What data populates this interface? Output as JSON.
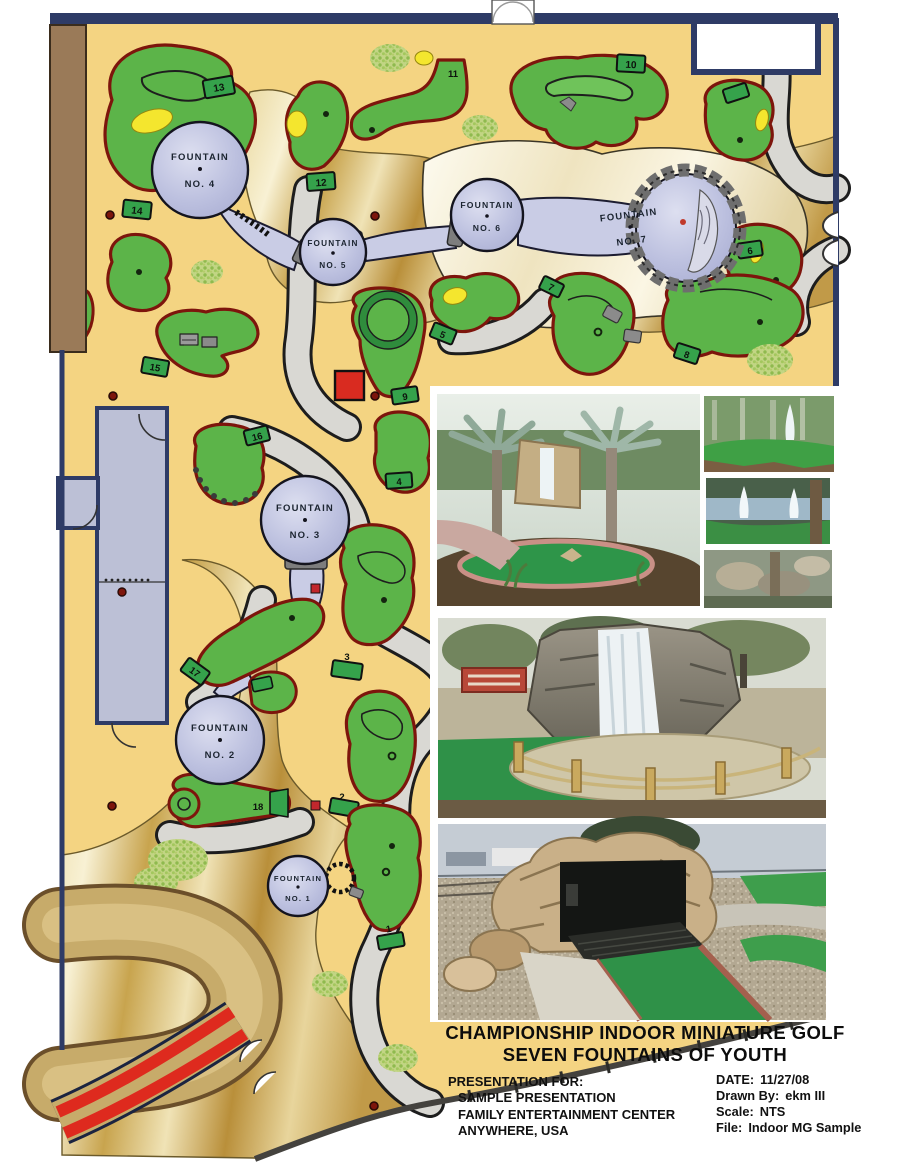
{
  "plan": {
    "fountains": [
      {
        "name": "FOUNTAIN",
        "no": "NO. 1"
      },
      {
        "name": "FOUNTAIN",
        "no": "NO. 2"
      },
      {
        "name": "FOUNTAIN",
        "no": "NO. 3"
      },
      {
        "name": "FOUNTAIN",
        "no": "NO. 4"
      },
      {
        "name": "FOUNTAIN",
        "no": "NO. 5"
      },
      {
        "name": "FOUNTAIN",
        "no": "NO. 6"
      },
      {
        "name": "FOUNTAIN",
        "no": "NO. 7"
      }
    ],
    "hole_numbers": [
      "1",
      "2",
      "3",
      "4",
      "5",
      "6",
      "7",
      "8",
      "9",
      "10",
      "11",
      "12",
      "13",
      "14",
      "15",
      "16",
      "17",
      "18"
    ]
  },
  "title_block": {
    "line1": "CHAMPIONSHIP INDOOR MINIATURE GOLF",
    "line2": "SEVEN FOUNTAINS OF YOUTH"
  },
  "presentation": {
    "heading": "PRESENTATION FOR:",
    "line1": "SAMPLE PRESENTATION",
    "line2": "FAMILY ENTERTAINMENT CENTER",
    "line3": "ANYWHERE, USA"
  },
  "meta": {
    "date_label": "DATE:",
    "date": "11/27/08",
    "drawn_label": "Drawn By:",
    "drawn": "ekm III",
    "scale_label": "Scale:",
    "scale": "NTS",
    "file_label": "File:",
    "file": "Indoor MG Sample"
  },
  "colors": {
    "floor_tan": "#F4D482",
    "hole_green": "#5CB449",
    "hole_border_maroon": "#7D150C",
    "tee_green": "#35A24B",
    "gold_river": "#C79A44",
    "fountain_lavender": "#B4B8DB",
    "walkway_gray": "#D9D8D3",
    "wall_navy": "#2E3B66",
    "ramp_red": "#DE2A1E",
    "accent_yellow": "#F4E62E",
    "room_gray": "#BCC0D6",
    "door_brown": "#9A7A58"
  }
}
